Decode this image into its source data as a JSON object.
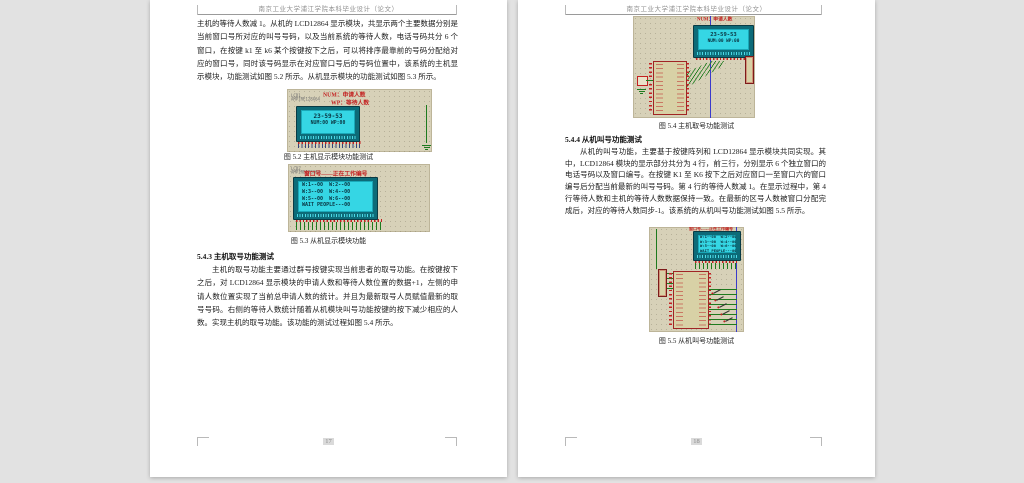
{
  "window": {
    "background": "#e2e2e2",
    "page_color": "#ffffff"
  },
  "colors": {
    "sim_background": "#d7d1b8",
    "lcd_screen_cyan": "#35d6e4",
    "lcd_frame_teal": "#0d6b78",
    "annotation_red": "#c32121",
    "wire_green": "#1e7a1e",
    "bus_blue": "#3a3acc"
  },
  "pages": {
    "left": {
      "header": "南京工业大学浦江学院本科毕业设计（论文）",
      "page_number": "17",
      "continuation_paragraph": "主机的等待人数减 1。从机的 LCD12864 显示模块，共显示两个主要数据分别是当前窗口号所对应的叫号号码，以及当前系统的等待人数，电话号码共分 6 个窗口，在按键 k1 至 k6 某个按键按下之后，可以将排序最靠前的号码分配给对应的窗口号，同时该号码显示在对应窗口号后的号码位置中，该系统的主机显示模块，功能测试如图 5.2 所示。从机显示模块的功能测试如图 5.3 所示。",
      "figure_5_2": {
        "caption": "图 5.2 主机显示模块功能测试",
        "part_ref": "LCD1",
        "part_model": "AMPIRE128X64",
        "annotation_line1": "NUM：申请人数",
        "annotation_line2": "WP：等待人数",
        "screen": {
          "line1": "23-59-53",
          "line2": "NUM:00  WP:00"
        }
      },
      "figure_5_3": {
        "caption": "图 5.3 从机显示模块功能",
        "part_ref": "LCD2",
        "part_model": "AMPIRE128X64",
        "annotation": "窗口号——正在工作编号",
        "screen_lines": [
          "W:1--00  W:2--00",
          "W:3--00  W:4--00",
          "W:5--00  W:6--00",
          "WAIT PEOPLE---00"
        ]
      },
      "section_5_4_3": {
        "heading": "5.4.3 主机取号功能测试",
        "body": "主机的取号功能主要通过群号按键实现当前患者的取号功能。在按键按下之后，对 LCD12864 显示模块的申请人数和等待人数位置的数据+1，左侧的申请人数位置实现了当前总申请人数的统计。并且为最新取号人员赋值最新的取号号码。右侧的等待人数统计随着从机模块叫号功能按键的按下减少相应的人数。实现主机的取号功能。该功能的测试过程如图 5.4 所示。"
      }
    },
    "right": {
      "header": "南京工业大学浦江学院本科毕业设计（论文）",
      "page_number": "18",
      "figure_5_4": {
        "caption": "图 5.4 主机取号功能测试",
        "annotation": "NUM：申请人数",
        "screen": {
          "line1": "23-59-53",
          "line2": "NUM:00  WP:00"
        }
      },
      "section_5_4_4": {
        "heading": "5.4.4 从机叫号功能测试",
        "body": "从机的叫号功能，主要基于按键阵列和 LCD12864 显示模块共同实现。其中，LCD12864 模块的显示部分共分为 4 行，前三行，分别显示 6 个独立窗口的电话号码以及窗口编号。在按键 K1 至 K6 按下之后对应窗口一至窗口六的窗口编号后分配当前最新的叫号号码。第 4 行的等待人数减 1。在显示过程中，第 4 行等待人数和主机的等待人数数据保持一致。在最新的区号人数被窗口分配完成后，对应的等待人数同步-1。该系统的从机叫号功能测试如图 5.5 所示。"
      },
      "figure_5_5": {
        "caption": "图 5.5 从机叫号功能测试",
        "annotation": "窗口号——正在工作编号",
        "screen_lines": [
          "W:1--00  W:2--00",
          "W:3--00  W:4--00",
          "W:5--00  W:6--00",
          "WAIT PEOPLE---00"
        ]
      }
    }
  }
}
